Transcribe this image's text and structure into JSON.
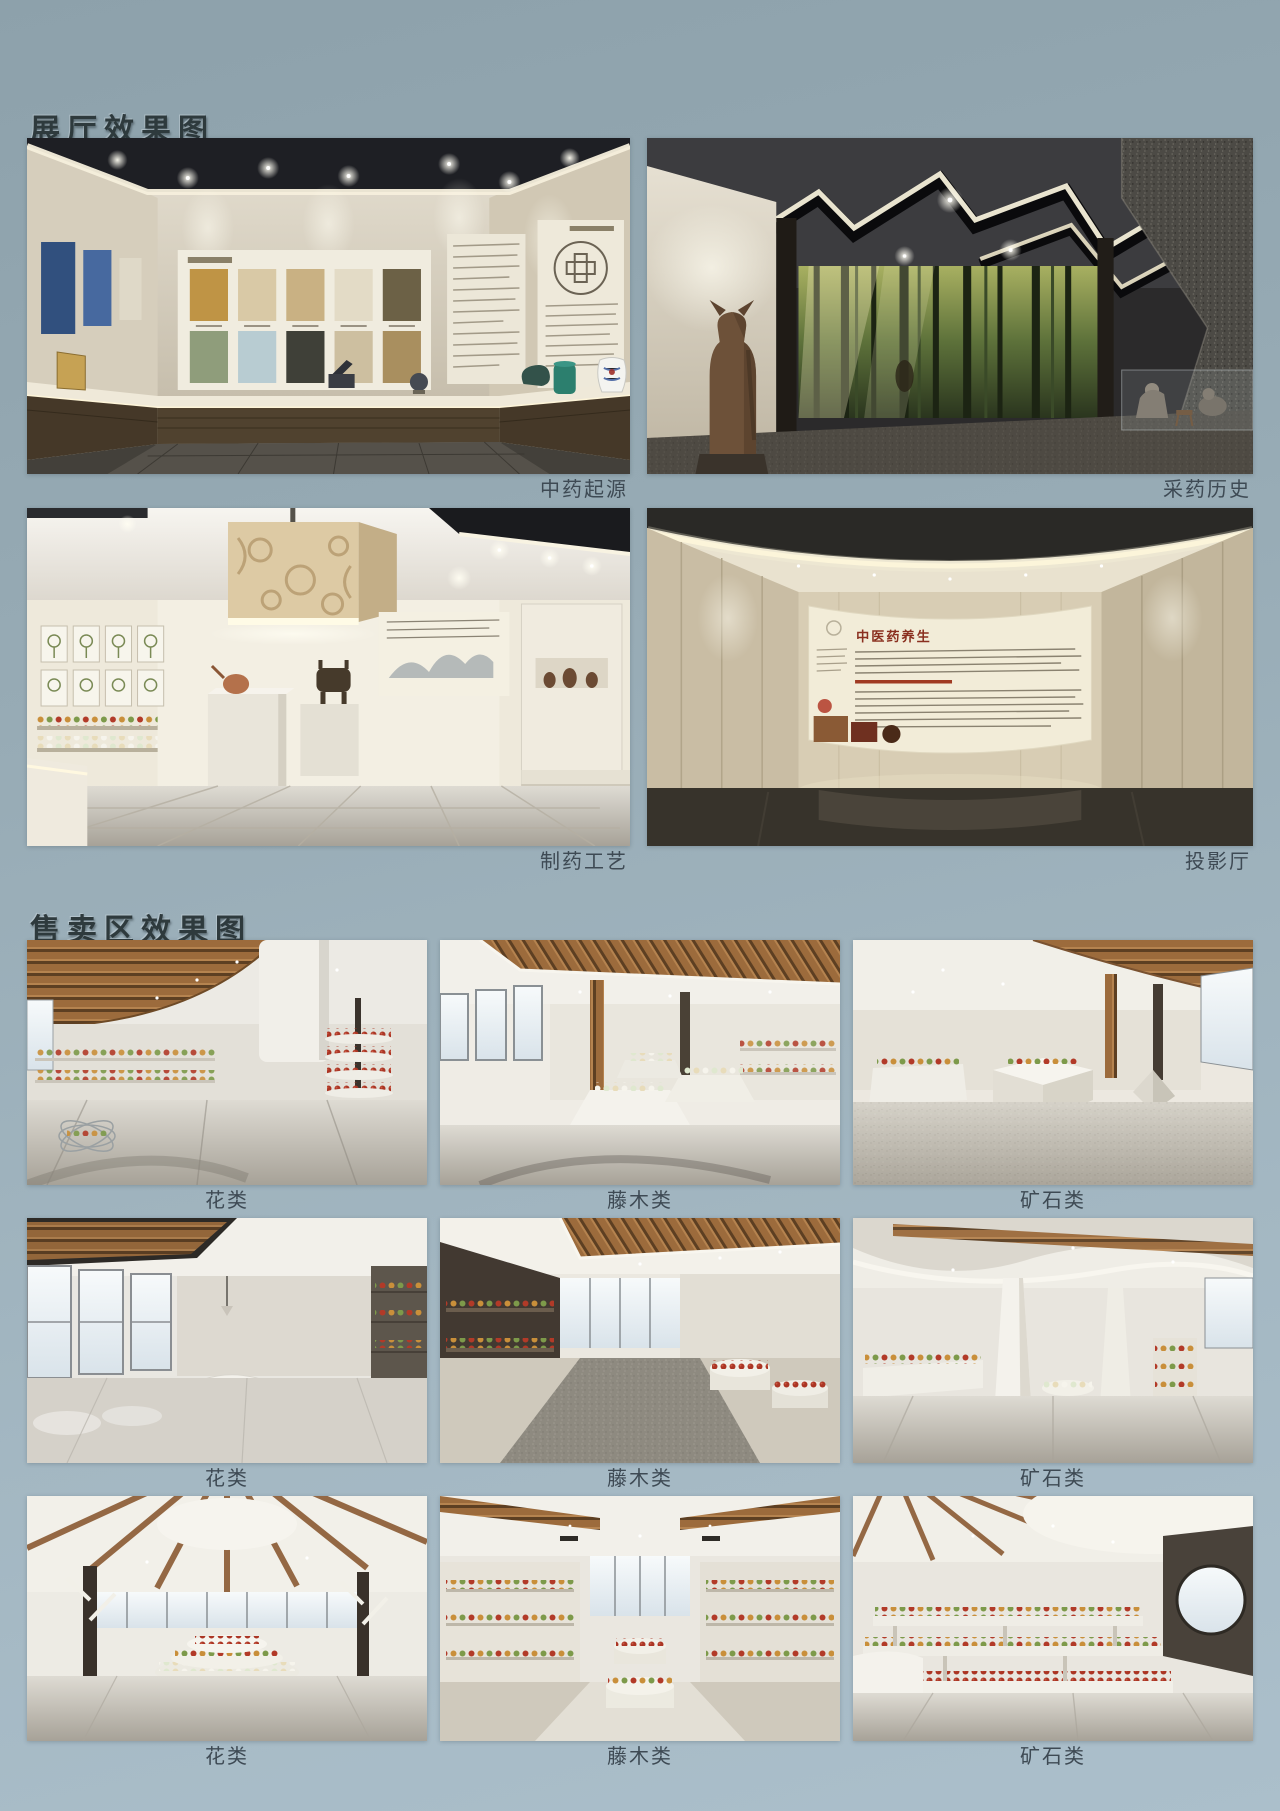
{
  "exhibition": {
    "heading": "展厅效果图",
    "items": [
      {
        "caption": "中药起源"
      },
      {
        "caption": "采药历史"
      },
      {
        "caption": "制药工艺"
      },
      {
        "caption": "投影厅",
        "screen_title": "中医药养生"
      }
    ]
  },
  "retail": {
    "heading": "售卖区效果图",
    "items": [
      {
        "caption": "花类"
      },
      {
        "caption": "藤木类"
      },
      {
        "caption": "矿石类"
      },
      {
        "caption": "花类"
      },
      {
        "caption": "藤木类"
      },
      {
        "caption": "矿石类"
      },
      {
        "caption": "花类"
      },
      {
        "caption": "藤木类"
      },
      {
        "caption": "矿石类"
      }
    ]
  },
  "colors": {
    "background_top": "#8da1ab",
    "background_bottom": "#abbfcb",
    "heading_text": "#2e3a3d",
    "caption_text": "#3e4a54",
    "wood_accent": "#9c6b3c",
    "jar_red": "#ab3524"
  }
}
